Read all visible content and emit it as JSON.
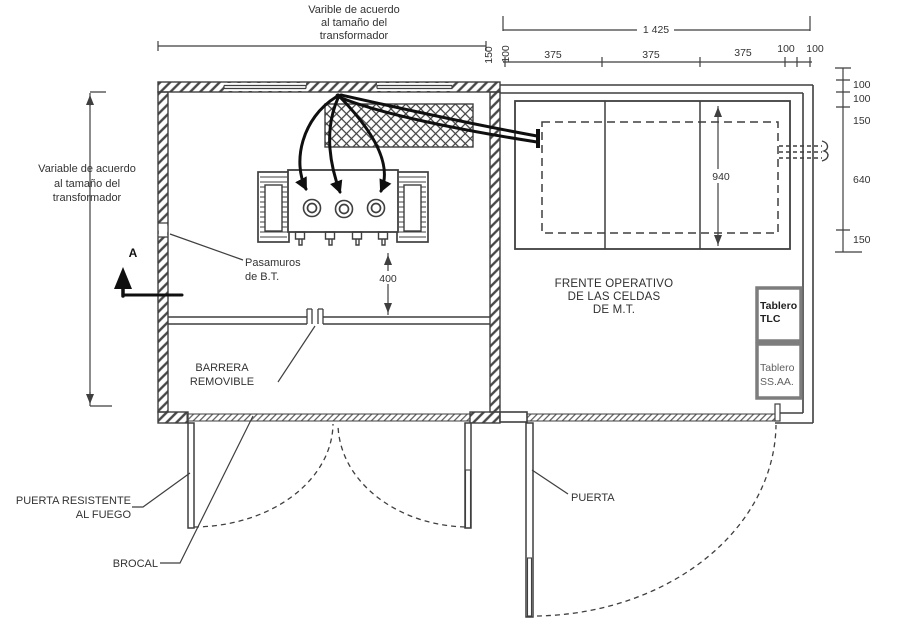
{
  "diagram": {
    "kind": "transformer-room-floor-plan"
  },
  "notes": {
    "top": {
      "l1": "Varible de acuerdo",
      "l2": "al tamaño del",
      "l3": "transformador"
    },
    "left": {
      "l1": "Variable de acuerdo",
      "l2": "al tamaño del",
      "l3": "transformador"
    }
  },
  "dims": {
    "overall": "1 425",
    "top_rotated": [
      "150",
      "100"
    ],
    "top_segments": [
      "375",
      "375",
      "375",
      "100",
      "100"
    ],
    "right_chain": [
      "100",
      "100",
      "150",
      "640",
      "150"
    ],
    "celda_front": "940",
    "bt_clearance": "400"
  },
  "labels": {
    "section": "A",
    "pasamuros": {
      "l1": "Pasamuros",
      "l2": "de B.T."
    },
    "barrera": {
      "l1": "BARRERA",
      "l2": "REMOVIBLE"
    },
    "frente": {
      "l1": "FRENTE OPERATIVO",
      "l2": "DE LAS CELDAS",
      "l3": "DE M.T."
    },
    "tablero_tlc": {
      "l1": "Tablero",
      "l2": "TLC"
    },
    "tablero_ssaa": {
      "l1": "Tablero",
      "l2": "SS.AA."
    },
    "puerta_fuego": {
      "l1": "PUERTA RESISTENTE",
      "l2": "AL FUEGO"
    },
    "brocal": "BROCAL",
    "puerta": "PUERTA"
  },
  "colors": {
    "line": "#3f3f3f",
    "cable": "#0f0f0f",
    "tablero_border": "#7d7d7d",
    "text": "#333333",
    "tablero_text_dark": "#1f1f1f",
    "tablero_text_gray": "#5f5f5f"
  }
}
